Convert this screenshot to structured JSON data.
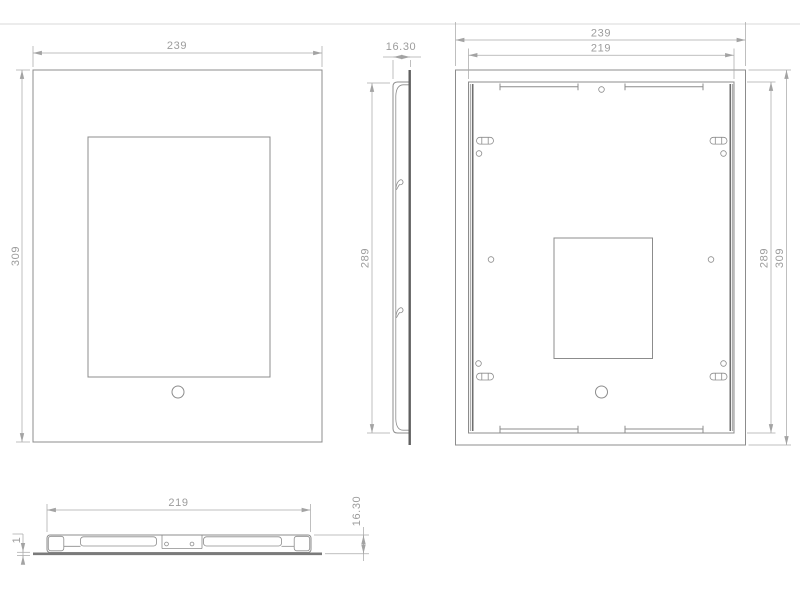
{
  "drawing": {
    "front_view": {
      "width": "239",
      "height": "309"
    },
    "side_view": {
      "depth": "16.30",
      "body_height": "289"
    },
    "back_view": {
      "outer_width": "239",
      "inner_width": "219",
      "inner_height": "289",
      "outer_height": "309"
    },
    "bottom_view": {
      "inner_width": "219",
      "depth": "16.30",
      "plate_thickness": "1"
    },
    "colors": {
      "outline": "#8c8c8c",
      "dark_edge": "#5f5f5f",
      "dimension_line": "#aaaaaa",
      "label_text": "#9c9c9c",
      "separator": "#d9d9d9",
      "background": "#ffffff"
    }
  }
}
